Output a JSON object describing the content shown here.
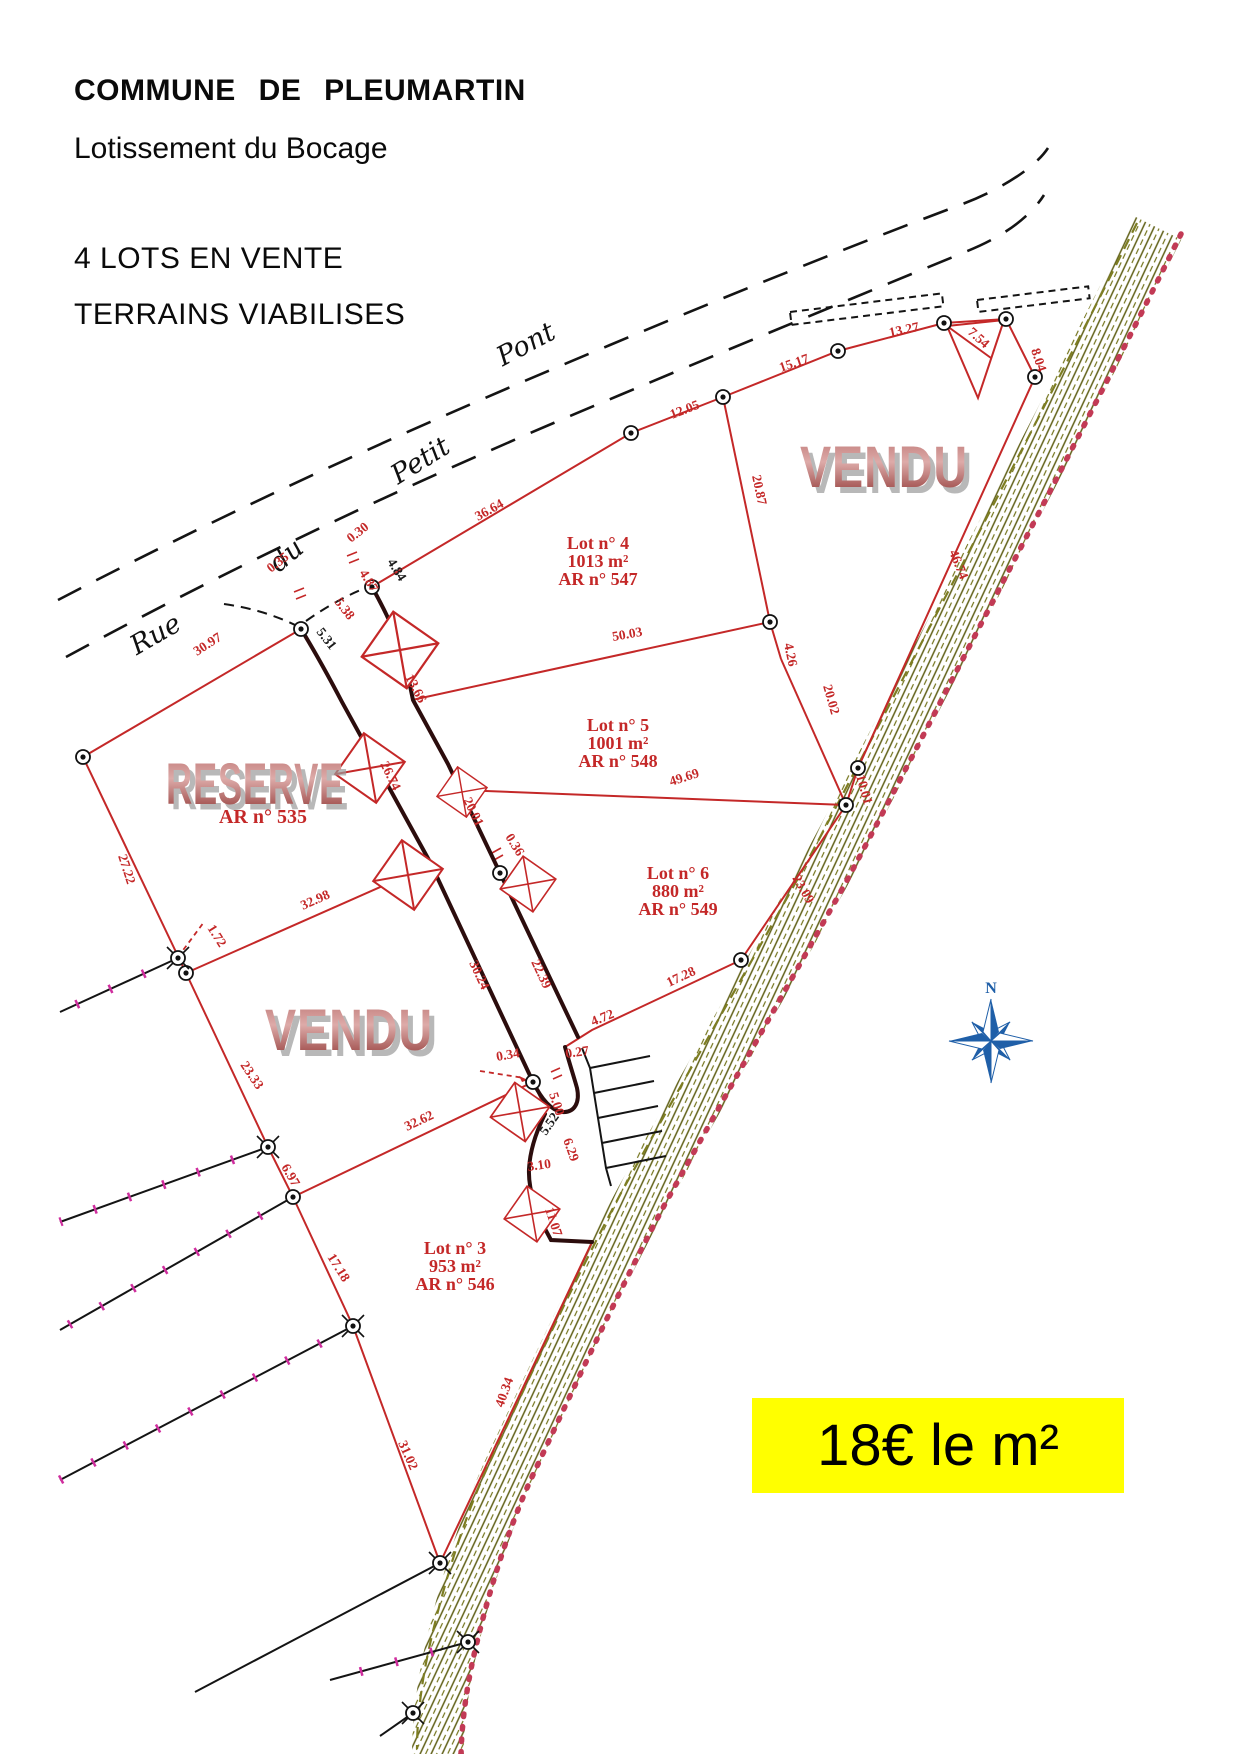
{
  "header": {
    "title": "COMMUNE DE PLEUMARTIN",
    "subtitle": "Lotissement du Bocage",
    "line1": "4 LOTS EN VENTE",
    "line2": "TERRAINS VIABILISES"
  },
  "price": "18€ le m²",
  "plan": {
    "street": [
      "Rue",
      "du",
      "Petit",
      "Pont"
    ],
    "stamps": {
      "vendu": "VENDU",
      "reserve": "RESERVE"
    },
    "compass": "N",
    "lots": [
      {
        "name": "Lot n° 4",
        "area": "1013 m²",
        "ar": "AR n° 547"
      },
      {
        "name": "Lot n° 5",
        "area": "1001 m²",
        "ar": "AR n° 548"
      },
      {
        "name": "Lot n° 6",
        "area": "880 m²",
        "ar": "AR n° 549"
      },
      {
        "name": "Lot n° 3",
        "area": "953 m²",
        "ar": "AR n° 546"
      }
    ],
    "reserve_ar": "AR n° 535",
    "dims": [
      "30.97",
      "27.22",
      "0.35",
      "5.38",
      "5.31",
      "0.30",
      "4.87",
      "4.84",
      "13.66",
      "26.74",
      "20.01",
      "36.64",
      "12.05",
      "15.17",
      "13.27",
      "7.54",
      "8.04",
      "46.74",
      "20.87",
      "4.26",
      "20.02",
      "10.01",
      "23.09",
      "50.03",
      "49.69",
      "0.36",
      "22.39",
      "30.24",
      "32.98",
      "1.72",
      "23.33",
      "6.97",
      "17.18",
      "31.02",
      "40.34",
      "32.62",
      "0.34",
      "5.00",
      "0.27",
      "4.72",
      "17.28",
      "5.52",
      "6.29",
      "3.10",
      "11.07"
    ]
  }
}
